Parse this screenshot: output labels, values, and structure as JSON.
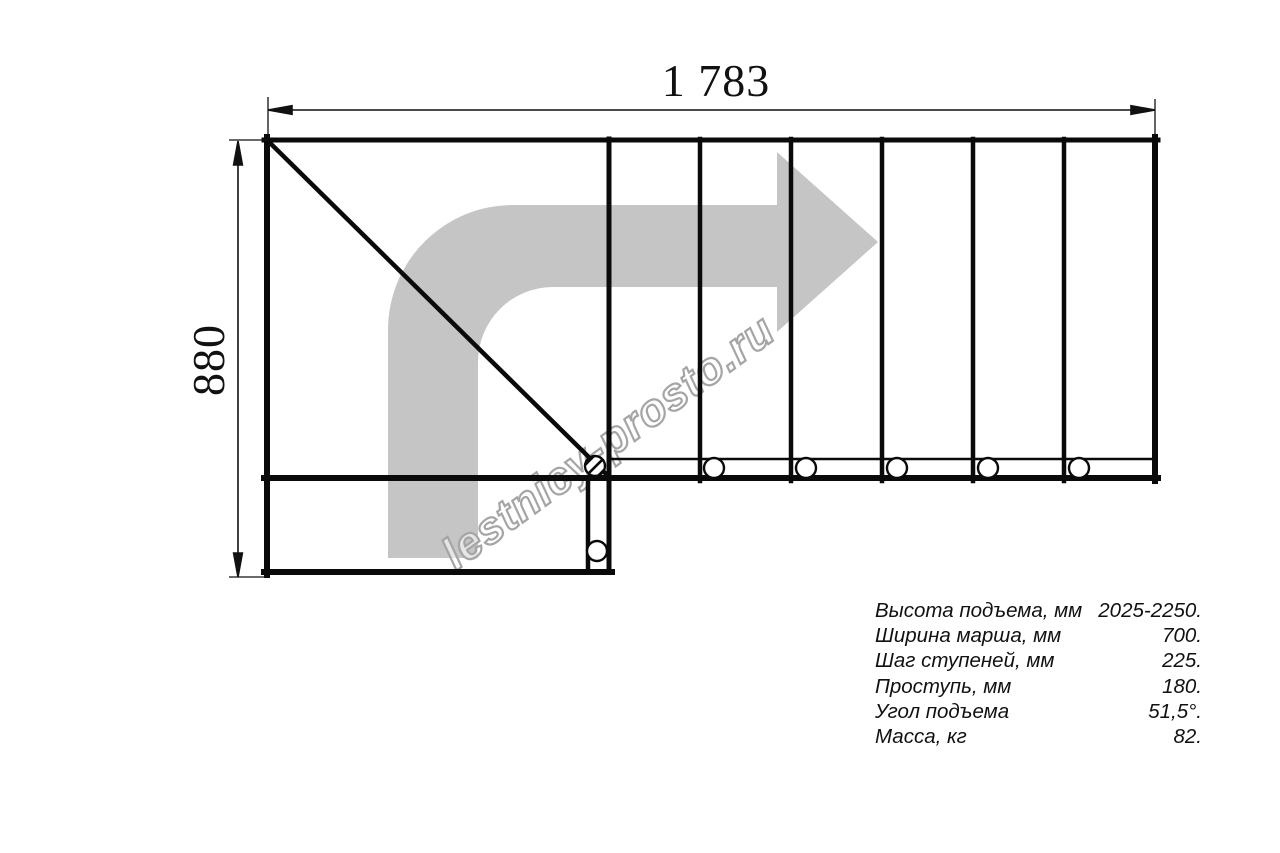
{
  "drawing": {
    "width_dim": "1 783",
    "height_dim": "880",
    "watermark": "lestnicy-prosto.ru",
    "arrow_color": "#c5c5c5",
    "line_color": "#0a0a0a",
    "watermark_outline": "#a5a5a5"
  },
  "specs": {
    "rows": [
      {
        "label": "Высота подъема, мм",
        "value": "2025-2250."
      },
      {
        "label": "Ширина марша, мм",
        "value": "700."
      },
      {
        "label": "Шаг ступеней, мм",
        "value": "225."
      },
      {
        "label": "Проступь, мм",
        "value": "180."
      },
      {
        "label": "Угол подъема",
        "value": "51,5°."
      },
      {
        "label": "Масса, кг",
        "value": "82."
      }
    ]
  }
}
